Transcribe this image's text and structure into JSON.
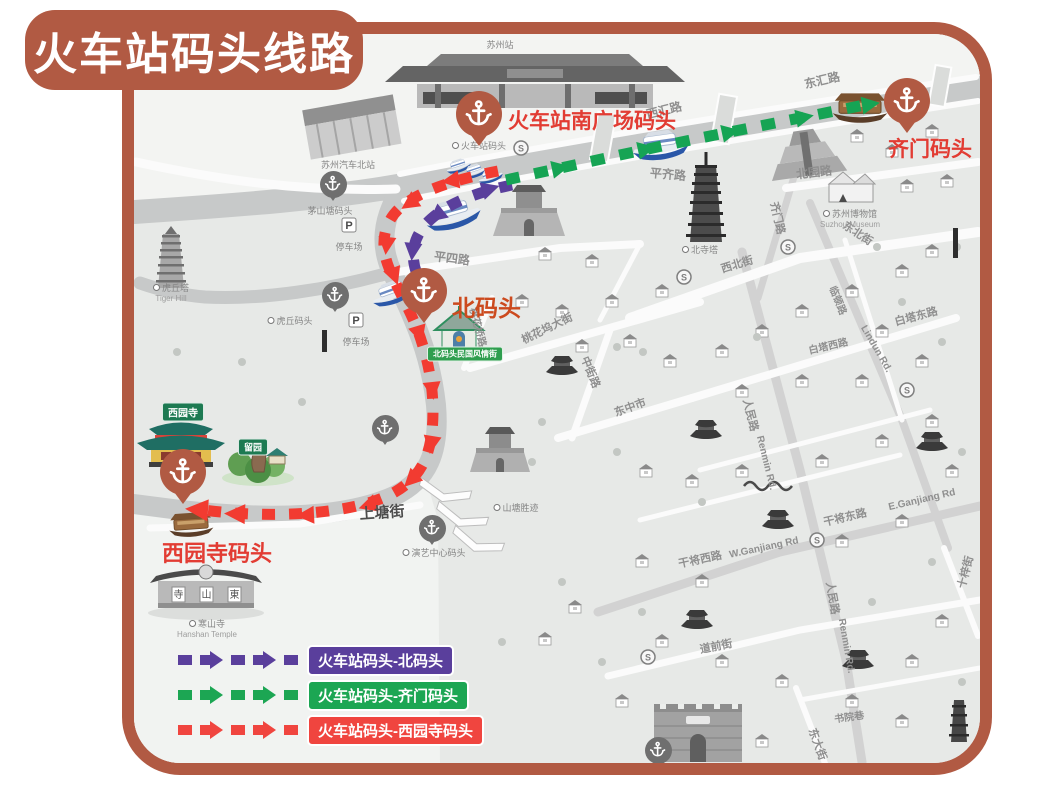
{
  "title": "火车站码头线路",
  "colors": {
    "frame": "#b15a43",
    "route_north": "#5a3f9c",
    "route_qimen": "#16a454",
    "route_xiyuan": "#f23b31"
  },
  "legend": {
    "items": [
      {
        "id": "north",
        "label": "火车站码头-北码头",
        "color": "#5a3f9c"
      },
      {
        "id": "qimen",
        "label": "火车站码头-齐门码头",
        "color": "#1ca653"
      },
      {
        "id": "xiyuan",
        "label": "火车站码头-西园寺码头",
        "color": "#f0453f"
      }
    ]
  },
  "docks": [
    {
      "id": "station-south",
      "label": "火车站南广场码头",
      "pin": {
        "x": 479,
        "y": 114
      },
      "label_pos": {
        "x": 508,
        "y": 105,
        "size": 21
      },
      "label_color": "#e23c33"
    },
    {
      "id": "qimen",
      "label": "齐门码头",
      "pin": {
        "x": 907,
        "y": 101
      },
      "label_pos": {
        "x": 888,
        "y": 133,
        "size": 21
      },
      "label_color": "#e23c33"
    },
    {
      "id": "north",
      "label": "北码头",
      "pin": {
        "x": 424,
        "y": 291
      },
      "label_pos": {
        "x": 452,
        "y": 289,
        "size": 23
      },
      "label_color": "#cc4a1e"
    },
    {
      "id": "xiyuan",
      "label": "西园寺码头",
      "pin": {
        "x": 183,
        "y": 472
      },
      "label_pos": {
        "x": 162,
        "y": 536,
        "size": 22
      },
      "label_color": "#e23c33"
    }
  ],
  "minor_docks": [
    {
      "x": 333,
      "y": 184
    },
    {
      "x": 335,
      "y": 295
    },
    {
      "x": 385,
      "y": 428
    },
    {
      "x": 432,
      "y": 528
    },
    {
      "x": 658,
      "y": 750
    }
  ],
  "poi_labels": [
    {
      "t": "苏州站",
      "x": 500,
      "y": 40,
      "dot": false
    },
    {
      "t": "苏州汽车北站",
      "x": 348,
      "y": 160,
      "dot": false
    },
    {
      "t": "火车站码头",
      "x": 479,
      "y": 141,
      "dot": true
    },
    {
      "t": "茅山塘码头",
      "x": 330,
      "y": 206,
      "dot": false
    },
    {
      "t": "虎丘塔",
      "en": "Tiger Hill",
      "x": 171,
      "y": 283,
      "dot": true
    },
    {
      "t": "虎丘码头",
      "x": 290,
      "y": 316,
      "dot": true
    },
    {
      "t": "苏州博物馆",
      "en": "Suzhou Museum",
      "x": 850,
      "y": 209,
      "dot": true
    },
    {
      "t": "北寺塔",
      "x": 700,
      "y": 245,
      "dot": true
    },
    {
      "t": "山塘胜迹",
      "x": 516,
      "y": 503,
      "dot": true
    },
    {
      "t": "演艺中心码头",
      "x": 434,
      "y": 548,
      "dot": true
    },
    {
      "t": "寒山寺",
      "en": "Hanshan Temple",
      "x": 207,
      "y": 619,
      "dot": true
    },
    {
      "t": "停车场",
      "x": 349,
      "y": 242,
      "dot": false
    },
    {
      "t": "停车场",
      "x": 356,
      "y": 337,
      "dot": false
    }
  ],
  "streets": [
    {
      "t": "西汇路",
      "x": 664,
      "y": 110,
      "r": -14,
      "s": 12
    },
    {
      "t": "东汇路",
      "x": 822,
      "y": 80,
      "r": -13,
      "s": 12
    },
    {
      "t": "平齐路",
      "x": 668,
      "y": 174,
      "r": 5,
      "s": 12
    },
    {
      "t": "北园路",
      "x": 814,
      "y": 172,
      "r": -7,
      "s": 12
    },
    {
      "t": "齐门路",
      "x": 778,
      "y": 218,
      "r": 77,
      "s": 11
    },
    {
      "t": "平四路",
      "x": 452,
      "y": 258,
      "r": 7,
      "s": 12
    },
    {
      "t": "桃花桥路",
      "x": 479,
      "y": 327,
      "r": 75,
      "s": 10
    },
    {
      "t": "桃花坞大街",
      "x": 547,
      "y": 328,
      "r": -26,
      "s": 11
    },
    {
      "t": "西北街",
      "x": 737,
      "y": 264,
      "r": -17,
      "s": 11
    },
    {
      "t": "东北街",
      "x": 858,
      "y": 233,
      "r": 33,
      "s": 11
    },
    {
      "t": "白塔东路",
      "x": 916,
      "y": 316,
      "r": -15,
      "s": 11
    },
    {
      "t": "白塔西路",
      "x": 828,
      "y": 345,
      "r": -13,
      "s": 10
    },
    {
      "t": "临顿路",
      "x": 839,
      "y": 300,
      "r": 68,
      "s": 10
    },
    {
      "t": "Lindun Rd.",
      "x": 876,
      "y": 349,
      "r": 60,
      "s": 10
    },
    {
      "t": "人民路",
      "x": 751,
      "y": 415,
      "r": 76,
      "s": 11
    },
    {
      "t": "Renmin Rd.",
      "x": 766,
      "y": 463,
      "r": 76,
      "s": 10
    },
    {
      "t": "人民路",
      "x": 833,
      "y": 598,
      "r": 80,
      "s": 11
    },
    {
      "t": "Renmin Rd.",
      "x": 846,
      "y": 646,
      "r": 80,
      "s": 10
    },
    {
      "t": "东中市",
      "x": 630,
      "y": 407,
      "r": -20,
      "s": 11
    },
    {
      "t": "中街路",
      "x": 591,
      "y": 372,
      "r": 68,
      "s": 11
    },
    {
      "t": "干将西路",
      "x": 700,
      "y": 559,
      "r": -12,
      "s": 11
    },
    {
      "t": "W.Ganjiang Rd",
      "x": 764,
      "y": 548,
      "r": -12,
      "s": 10
    },
    {
      "t": "干将东路",
      "x": 845,
      "y": 517,
      "r": -13,
      "s": 11
    },
    {
      "t": "E.Ganjiang Rd",
      "x": 922,
      "y": 500,
      "r": -13,
      "s": 10
    },
    {
      "t": "道前街",
      "x": 716,
      "y": 646,
      "r": -11,
      "s": 11
    },
    {
      "t": "十梓街",
      "x": 965,
      "y": 572,
      "r": -75,
      "s": 11
    },
    {
      "t": "东大街",
      "x": 818,
      "y": 744,
      "r": 70,
      "s": 11
    },
    {
      "t": "书院巷",
      "x": 849,
      "y": 716,
      "r": -8,
      "s": 10
    },
    {
      "t": "上塘街",
      "x": 382,
      "y": 512,
      "r": -4,
      "s": 15,
      "c": "#4d4d4d"
    }
  ],
  "plates": [
    {
      "t": "西园寺",
      "x": 183,
      "y": 412,
      "bg": "#1d7a52",
      "s": 10
    },
    {
      "t": "留园",
      "x": 253,
      "y": 447,
      "bg": "#1d7a52",
      "s": 9
    },
    {
      "t": "北码头民国风情街",
      "x": 465,
      "y": 354,
      "bg": "#2f9e4f",
      "s": 8
    }
  ],
  "hanshan": {
    "plaques": [
      "寺",
      "山",
      "東"
    ]
  },
  "parking": {
    "symbol": "P",
    "spots": [
      {
        "x": 349,
        "y": 225
      },
      {
        "x": 356,
        "y": 320
      }
    ]
  },
  "metro": {
    "symbol": "S",
    "spots": [
      {
        "x": 521,
        "y": 148
      },
      {
        "x": 788,
        "y": 247
      },
      {
        "x": 684,
        "y": 277
      },
      {
        "x": 907,
        "y": 390
      },
      {
        "x": 817,
        "y": 540
      },
      {
        "x": 648,
        "y": 657
      }
    ]
  }
}
